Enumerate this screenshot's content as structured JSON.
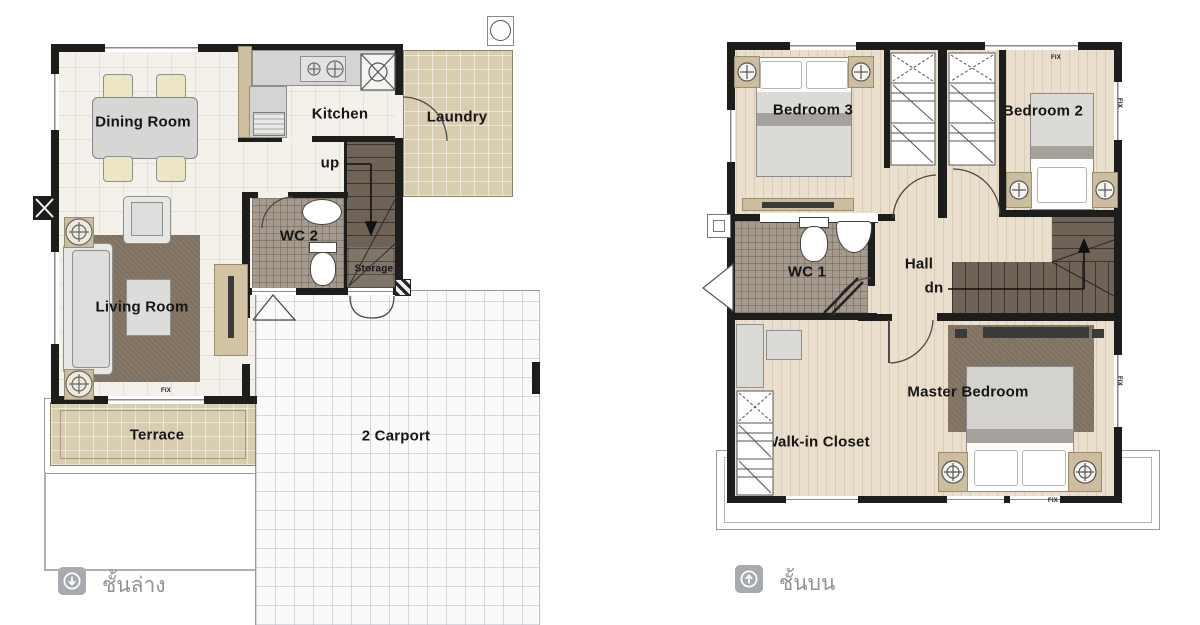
{
  "ground_floor": {
    "labels": {
      "dining_room": "Dining Room",
      "kitchen": "Kitchen",
      "laundry": "Laundry",
      "up": "up",
      "wc2": "WC 2",
      "storage": "Storage",
      "living_room": "Living Room",
      "terrace": "Terrace",
      "carport": "2 Carport"
    },
    "window_label": "FIX",
    "legend": {
      "label": "ชั้นล่าง",
      "icon": "down-arrow-circle"
    }
  },
  "upper_floor": {
    "labels": {
      "bedroom3": "Bedroom 3",
      "bedroom2": "Bedroom 2",
      "wc1": "WC 1",
      "hall": "Hall",
      "dn": "dn",
      "master_bedroom": "Master Bedroom",
      "walkin_closet": "Walk-in Closet"
    },
    "window_label": "FIX",
    "legend": {
      "label": "ชั้นบน",
      "icon": "up-arrow-circle"
    }
  },
  "colors": {
    "wall": "#1d1d1b",
    "tile_floor": "#f3f1ea",
    "tan_tile": "#d9cdb1",
    "wood_floor": "#eadfcd",
    "mosaic": "#a49a8e",
    "stairs": "#6e6356",
    "rug": "#877868",
    "carport": "#fafafb",
    "legend_badge": "#a7abb0",
    "legend_text": "#8d9296"
  }
}
